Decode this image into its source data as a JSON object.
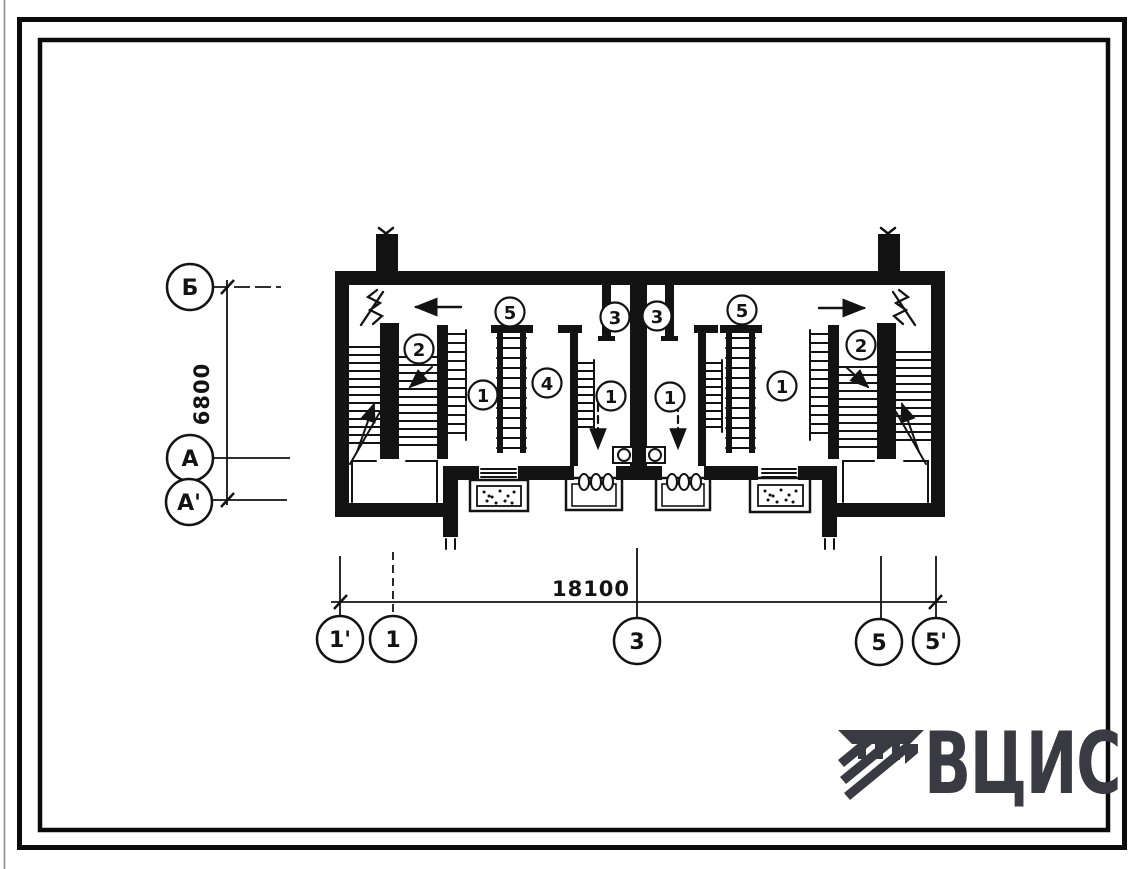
{
  "plan": {
    "dimension_horizontal": "18100",
    "dimension_vertical": "6800",
    "axes_left": [
      {
        "label": "Б"
      },
      {
        "label": "А"
      },
      {
        "label": "А'"
      }
    ],
    "axes_bottom": [
      {
        "label": "1'"
      },
      {
        "label": "1"
      },
      {
        "label": "3"
      },
      {
        "label": "5"
      },
      {
        "label": "5'"
      }
    ],
    "room_labels": [
      {
        "value": "2"
      },
      {
        "value": "5"
      },
      {
        "value": "1"
      },
      {
        "value": "4"
      },
      {
        "value": "1"
      },
      {
        "value": "3"
      },
      {
        "value": "3"
      },
      {
        "value": "5"
      },
      {
        "value": "1"
      },
      {
        "value": "1"
      },
      {
        "value": "2"
      }
    ]
  },
  "logo": {
    "text": "ВЦИС"
  },
  "colors": {
    "ink": "#131313",
    "logo": "#3a3a42",
    "paper": "#ffffff"
  }
}
